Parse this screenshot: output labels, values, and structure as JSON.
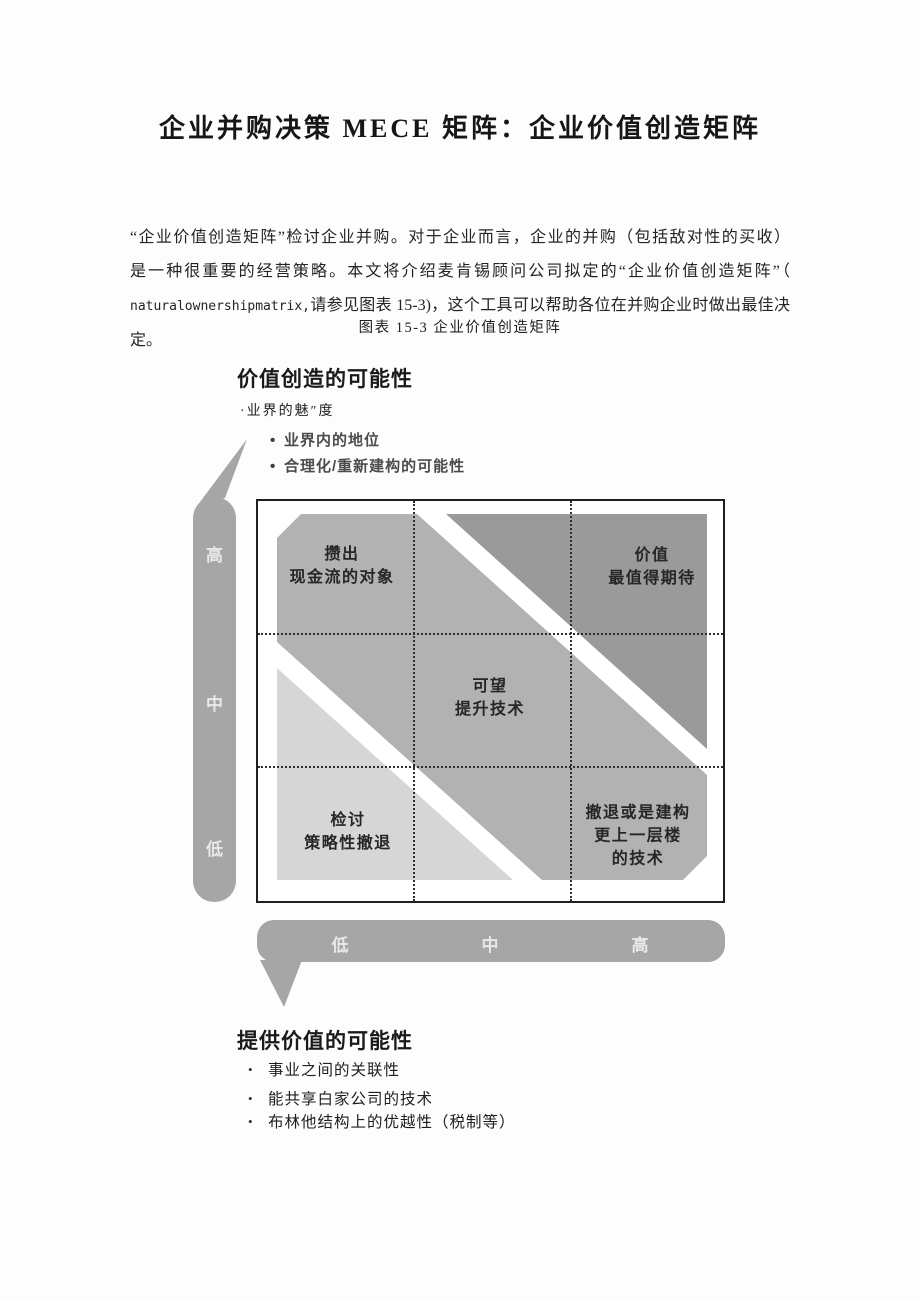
{
  "page": {
    "title": "企业并购决策 MECE 矩阵：企业价值创造矩阵",
    "paragraph": {
      "line1": "“企业价值创造矩阵”检讨企业并购。对于企业而言，企业的并购（包括敌对性的买收）",
      "line2": "是一种很重要的经营策略。本文将介绍麦肯锡顾问公司拟定的“企业价值创造矩阵”（",
      "line3_latin": "naturalownershipmatrix,",
      "line3_rest": "请参见图表 15-3)，这个工具可以帮助各位在并购企业时做出最佳决定。"
    },
    "caption": "图表 15-3 企业价值创造矩阵"
  },
  "diagram": {
    "y_axis": {
      "heading": "价值创造的可能性",
      "sub_marker": "·",
      "sub_bullet": "业界的魅″度",
      "bullet_marker": "•",
      "bullets": [
        "业界内的地位",
        "合理化/重新建构的可能性"
      ],
      "levels": [
        "高",
        "中",
        "低"
      ]
    },
    "x_axis": {
      "heading": "提供价值的可能性",
      "bullet_marker": "•",
      "bullets": [
        "事业之间的关联性",
        "能共享白家公司的技术",
        "布林他结构上的优越性（税制等）"
      ],
      "levels": [
        "低",
        "中",
        "高"
      ]
    },
    "matrix": {
      "cells": {
        "top_left": [
          "攒出",
          "现金流的对象"
        ],
        "top_right": [
          "价值",
          "最值得期待"
        ],
        "center": [
          "可望",
          "提升技术"
        ],
        "bottom_left": [
          "检讨",
          "策略性撤退"
        ],
        "bottom_right": [
          "撤退或是建构",
          "更上一层楼",
          "的技术"
        ]
      }
    },
    "colors": {
      "band_dark": "#9a9a9a",
      "band_mid": "#b2b2b2",
      "band_light": "#d6d6d6",
      "axis_bar": "#a6a6a6"
    }
  }
}
